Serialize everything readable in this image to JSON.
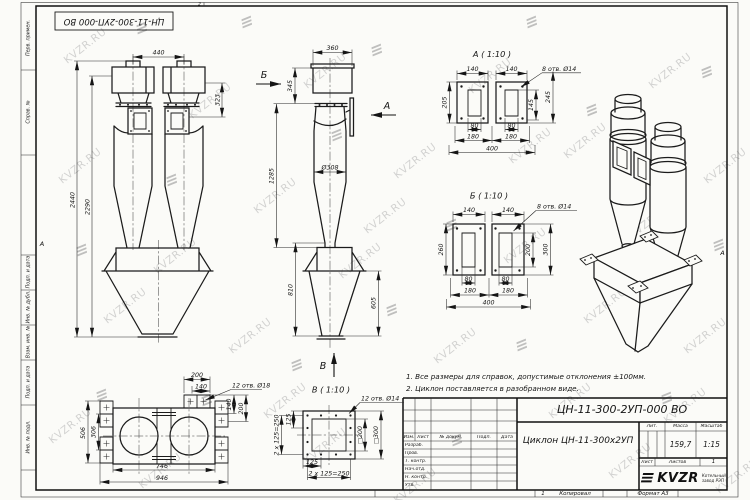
{
  "watermark": {
    "text": "KVZR.RU",
    "logo_glyph": "≡"
  },
  "frame": {
    "doc_box": "ЦН-11-300-2УП-000 ВО",
    "margin": {
      "perv": "Перв. примен.",
      "sprav": "Справ. №",
      "pd1": "Подп. и дата",
      "inv_dub": "Инв. № дубл.",
      "vzam": "Взам. инв. №",
      "pd2": "Подп. и дата",
      "inv_podl": "Инв. № подл."
    },
    "fold_left": "А",
    "fold_right": "А",
    "zone_top": "2",
    "copy_num": "1",
    "copied": "Копировал",
    "format": "Формат А3"
  },
  "notes": {
    "n1": "1. Все размеры для справок, допустимые отклонения ±100мм.",
    "n2": "2. Циклон поставляется в разобранном виде."
  },
  "title_block": {
    "doc_number": "ЦН-11-300-2УП-000 ВО",
    "product": "Циклон ЦН-11-300х2УП",
    "cols": {
      "izm": "Изм.",
      "list": "Лист",
      "doc": "№ докум.",
      "podp": "Подп.",
      "data": "Дата"
    },
    "rows": {
      "razrab": "Разраб.",
      "prov": "Пров.",
      "tkontr": "Т. контр.",
      "nach": "Нач.отд.",
      "nkontr": "Н. контр.",
      "utv": "Утв."
    },
    "lit_label": "Лит.",
    "mass_label": "Масса",
    "scale_label": "Масштаб",
    "mass": "159,7",
    "scale": "1:15",
    "sheet_label": "Лист",
    "sheets_label": "Листов",
    "sheets_value": "1",
    "logo_text": "KVZR",
    "company": "Котельный завод РЭП"
  },
  "views": {
    "front": {
      "d440": "440",
      "d323": "323",
      "d2440": "2440",
      "d2290": "2290"
    },
    "side": {
      "arrow_b": "Б",
      "arrow_a": "А",
      "arrow_v": "В",
      "d360": "360",
      "d345": "345",
      "d1285": "1285",
      "d308": "Ø308",
      "d810": "810",
      "d605": "605"
    },
    "viewA": {
      "title": "А ( 1:10 )",
      "holes": "8 отв. Ø14",
      "d140a": "140",
      "d140b": "140",
      "d205": "205",
      "d145": "145",
      "d245": "245",
      "d80a": "80",
      "d80b": "80",
      "d180a": "180",
      "d180b": "180",
      "d400": "400"
    },
    "viewB": {
      "title": "Б ( 1:10 )",
      "holes": "8 отв. Ø14",
      "d140a": "140",
      "d140b": "140",
      "d260": "260",
      "d200": "200",
      "d300": "300",
      "d80a": "80",
      "d80b": "80",
      "d180a": "180",
      "d180b": "180",
      "d400": "400"
    },
    "viewV": {
      "title": "В ( 1:10 )",
      "holes": "12 отв. Ø14",
      "d125l": "125",
      "d250l": "2 х 125=250",
      "sq200": "□200",
      "sq300": "□300",
      "d125b": "125",
      "d250b": "2 х 125=250"
    },
    "plan": {
      "holes": "12 отв. Ø18",
      "d200t": "200",
      "d140t": "140",
      "d506": "506",
      "d306": "306",
      "d140r": "140",
      "d200r": "200",
      "d746": "746",
      "d946": "946"
    }
  }
}
